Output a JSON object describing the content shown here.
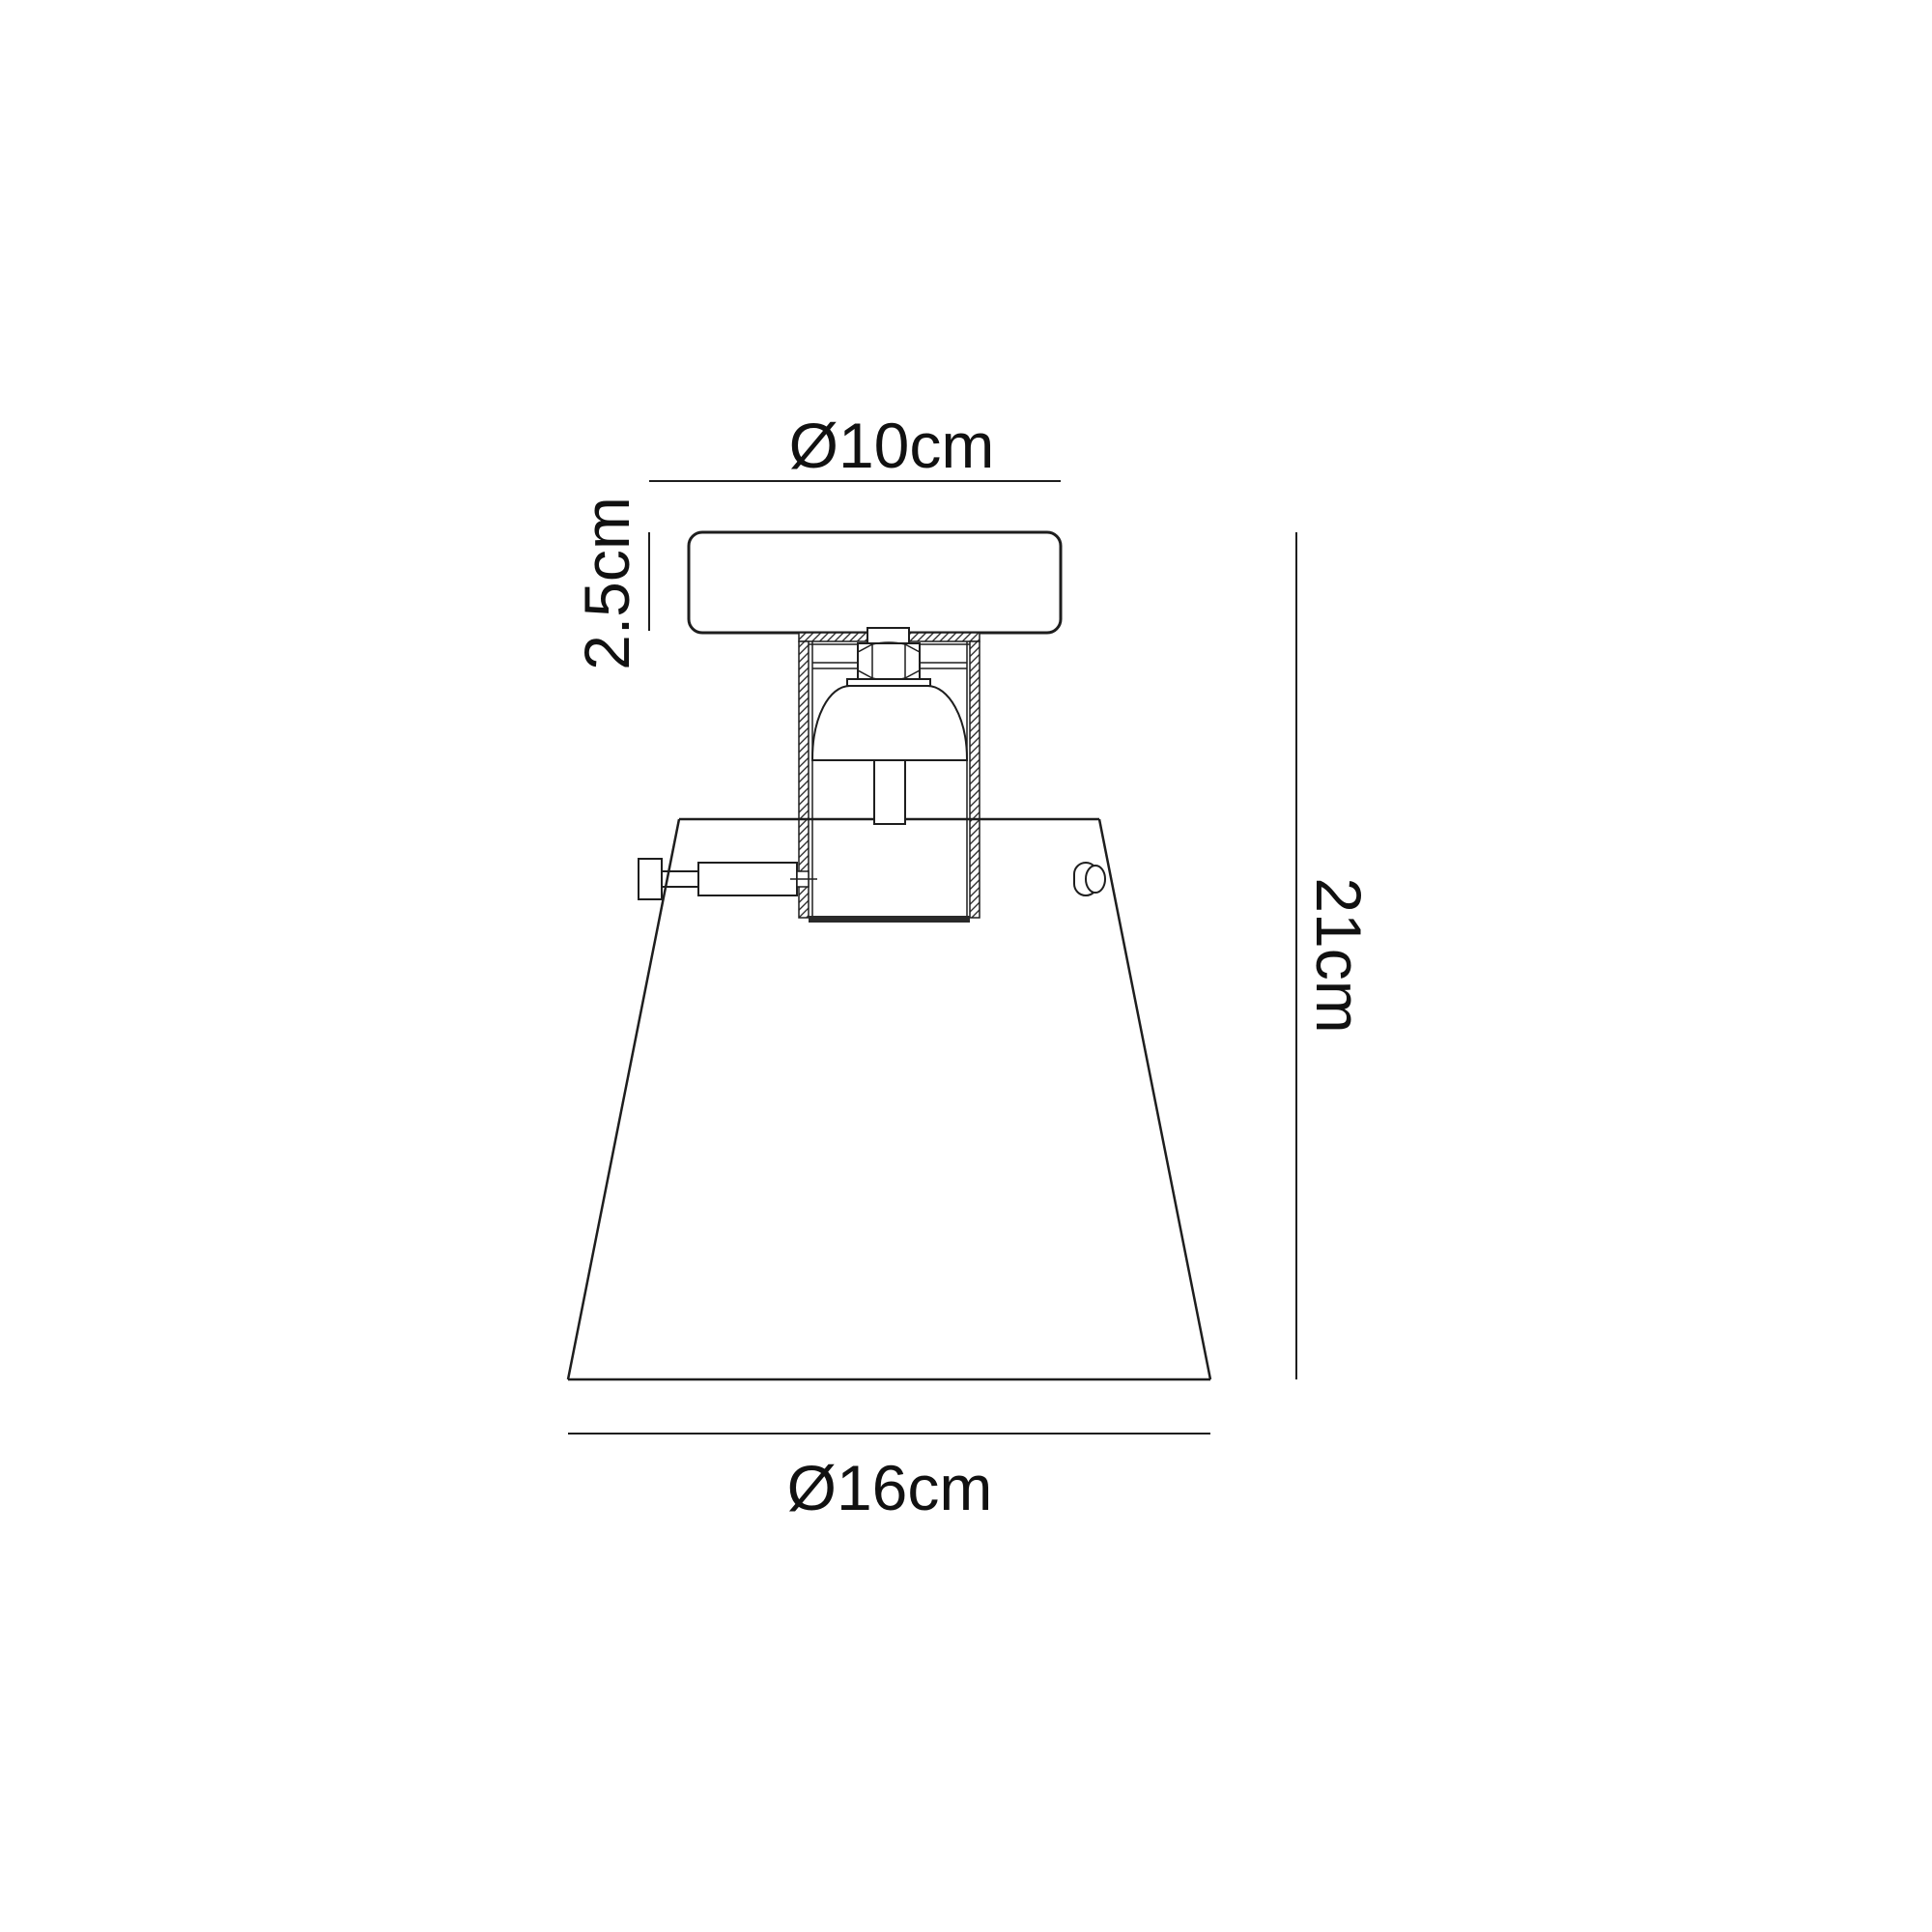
{
  "drawing": {
    "type": "technical-dimension-diagram",
    "subject": "flush-mount ceiling light fixture, side elevation",
    "background_color": "#ffffff",
    "line_color": "#1e1e1e",
    "dimensions": {
      "canopy_diameter_label": "Ø10cm",
      "canopy_height_label": "2.5cm",
      "overall_height_label": "21cm",
      "shade_diameter_label": "Ø16cm"
    }
  }
}
